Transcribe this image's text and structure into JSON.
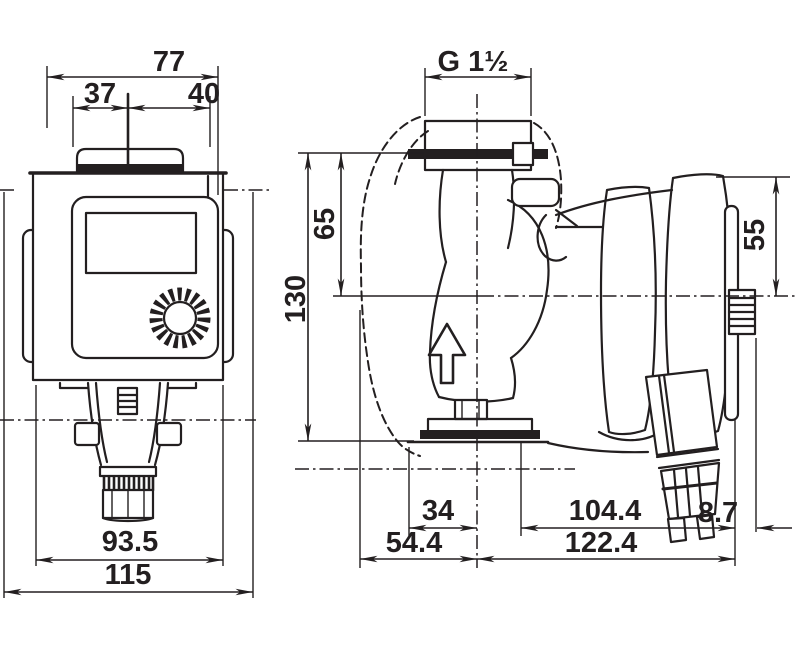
{
  "drawing": {
    "type": "pump-dimensional-drawing",
    "line_color": "#231f20",
    "background_color": "#ffffff"
  },
  "dims": {
    "front_total_width": "77",
    "front_width_left": "37",
    "front_width_right": "40",
    "front_body_width": "93.5",
    "front_overall_width": "115",
    "port_thread": "G 1½",
    "flange_to_axis": "65",
    "flange_to_flange": "130",
    "axis_to_motor_top": "55",
    "axis_to_front_plate": "34",
    "front_depth": "54.4",
    "axis_to_motor_end": "104.4",
    "motor_end_extra": "8.7",
    "total_depth": "122.4"
  }
}
